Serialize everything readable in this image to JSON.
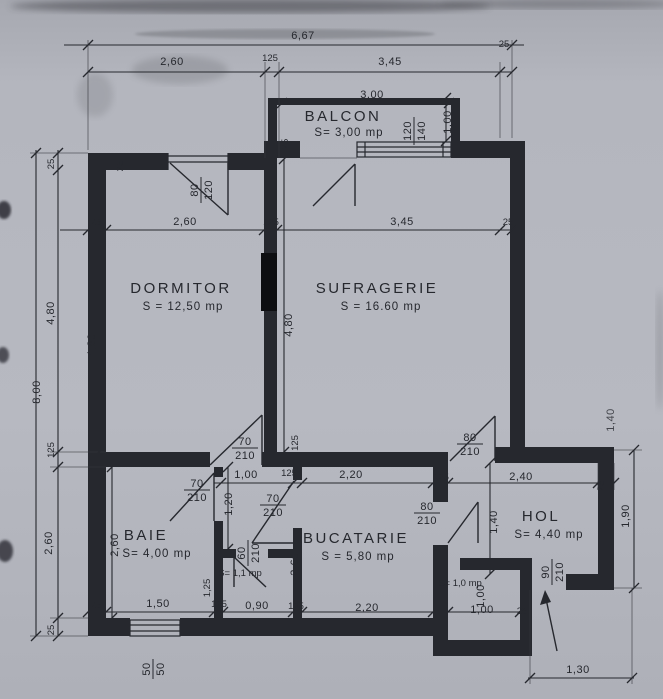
{
  "paper": {
    "bg": "#b3b5bd",
    "ink": "#26282e"
  },
  "rooms": {
    "balcon": {
      "name": "BALCON",
      "area": "S= 3,00 mp"
    },
    "dormitor": {
      "name": "DORMITOR",
      "area": "S = 12,50 mp"
    },
    "sufragerie": {
      "name": "SUFRAGERIE",
      "area": "S = 16.60 mp"
    },
    "baie": {
      "name": "BAIE",
      "area": "S= 4,00 mp"
    },
    "bucatarie": {
      "name": "BUCATARIE",
      "area": "S = 5,80 mp"
    },
    "hol": {
      "name": "HOL",
      "area": "S= 4,40 mp"
    },
    "camara": {
      "area": "S= 1,1 mp"
    },
    "debara": {
      "area": "S= 1,0 mp"
    }
  },
  "doors": {
    "dormitor": {
      "w": "70",
      "h": "210"
    },
    "sufragerie": {
      "w": "80",
      "h": "210"
    },
    "baie": {
      "w": "70",
      "h": "210"
    },
    "vestibul": {
      "w": "70",
      "h": "210"
    },
    "camara": {
      "w": "60",
      "h": "210"
    },
    "bucatarie": {
      "w": "80",
      "h": "210"
    },
    "intrare": {
      "w": "90",
      "h": "210"
    }
  },
  "windows": {
    "dormitor": {
      "w": "80",
      "h": "120"
    },
    "balcon": {
      "w": "120",
      "h": "140"
    },
    "baie": {
      "w": "50",
      "h": "50"
    }
  },
  "dims": {
    "total": "6,67",
    "t1": "2,60",
    "t2": "125",
    "t3": "3,45",
    "t4": "25",
    "c1": "25",
    "c2": "2,60",
    "c3": "125",
    "c4": "3,45",
    "c5": "25",
    "l_total": "8,00",
    "l1": "25",
    "l2": "4,80",
    "l3": "125",
    "l4": "2,60",
    "l5": "25",
    "dormitor_h": "4,80",
    "sufragerie_h": "4,80",
    "balcon_w": "3,00",
    "balcon_d": "1,00",
    "f1": "1,00",
    "f2": "125",
    "f3": "2,20",
    "f4": "125",
    "f5": "2,40",
    "f6": "25",
    "vestibul_h": "1,20",
    "baie_h": "2,60",
    "bucatarie_h": "2,60",
    "camara_h": "1,25",
    "hol_h": "1,40",
    "hol_right": "1,90",
    "hol_up": "1,40",
    "debara_h": "1,00",
    "g1": "25",
    "g2": "1,50",
    "g3": "125",
    "g4": "0,90",
    "g5": "125",
    "g6": "2,20",
    "g7": "1,00",
    "g8": "25",
    "entry_w": "1,30",
    "k_corner": "25",
    "b_corner": "25",
    "buc_wall": "125"
  }
}
